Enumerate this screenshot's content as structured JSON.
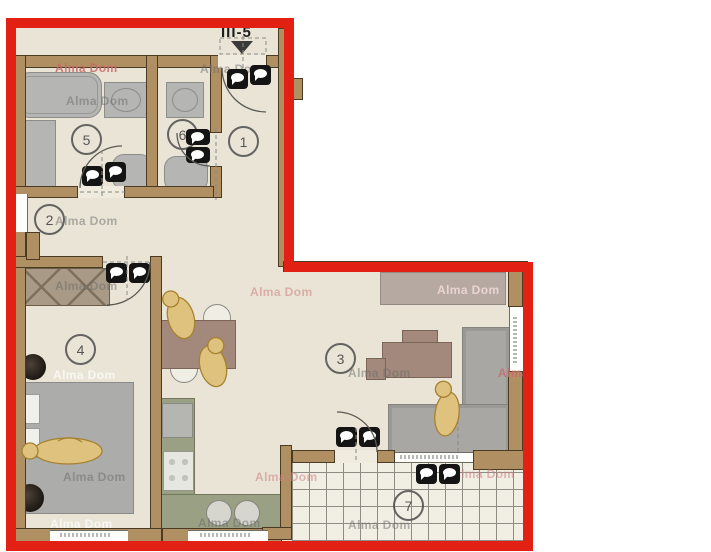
{
  "plan": {
    "unit_label": "III-5",
    "watermark_text": "Alma Dom",
    "rooms": [
      {
        "number": "1"
      },
      {
        "number": "2"
      },
      {
        "number": "3"
      },
      {
        "number": "4"
      },
      {
        "number": "5"
      },
      {
        "number": "6"
      },
      {
        "number": "7"
      }
    ],
    "colors": {
      "outline_red": "#e22114",
      "wall_brown": "#b08f63",
      "floor_beige": "#e9e4d6",
      "furniture_gray": "#b5b5b3",
      "kitchen_olive": "#9aa084",
      "figure_gold": "#e0c27f",
      "watermark_pink": "#c96a6a",
      "stamp_black": "#141414"
    }
  }
}
